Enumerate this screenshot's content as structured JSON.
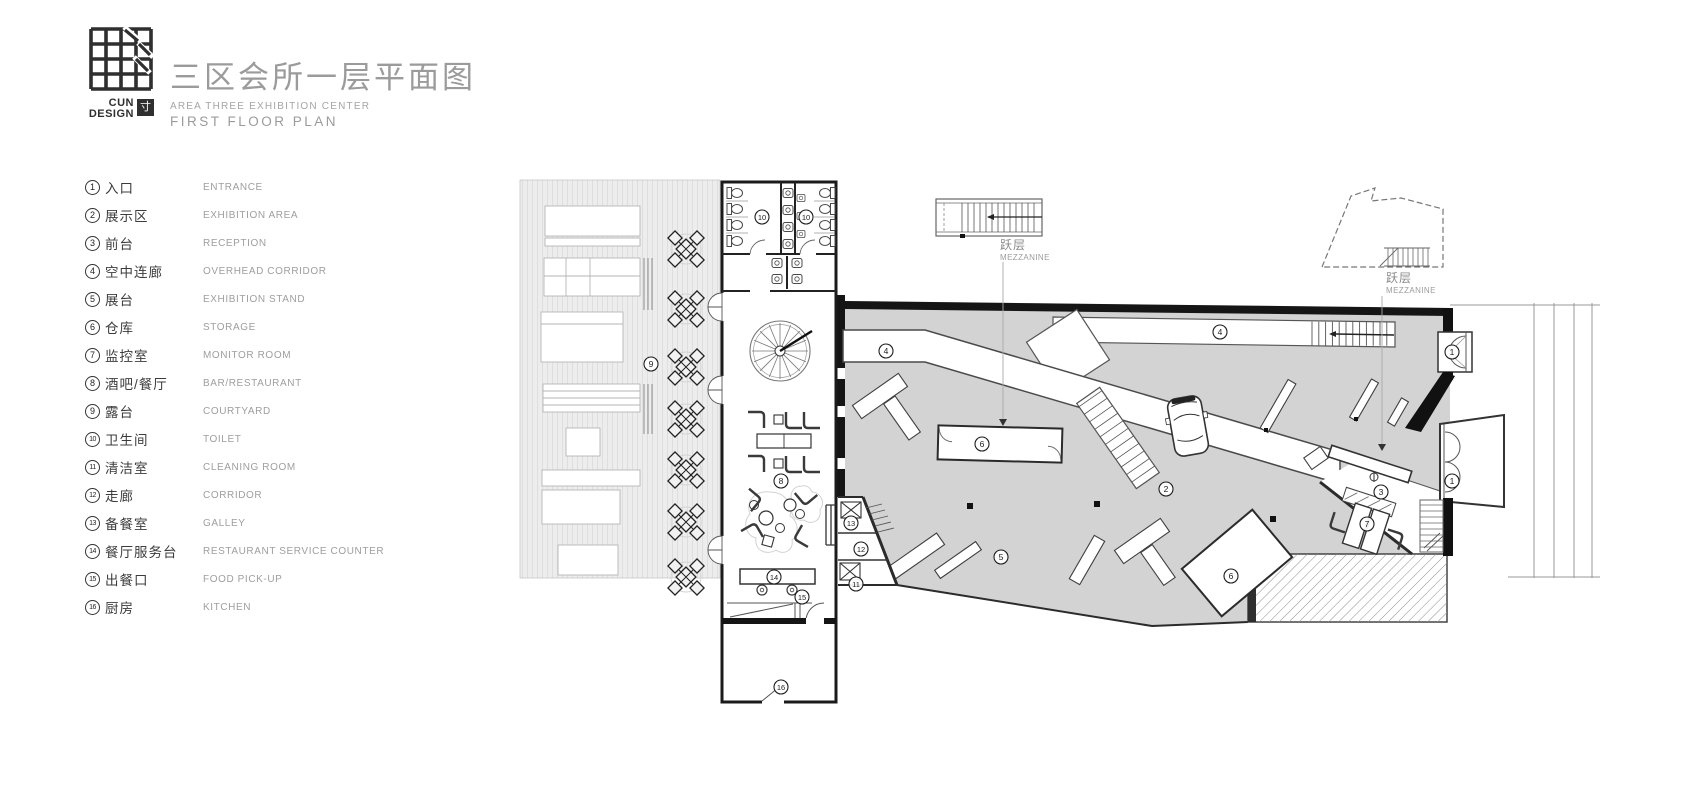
{
  "header": {
    "brand_top": "CUN",
    "brand_bottom": "DESIGN",
    "brand_seal": "寸",
    "title": "三区会所一层平面图",
    "subtitle_line1": "AREA THREE EXHIBITION CENTER",
    "subtitle_line2": "FIRST FLOOR PLAN"
  },
  "legend": {
    "items": [
      {
        "num": "1",
        "cn": "入口",
        "en": "ENTRANCE",
        "key": "entrance"
      },
      {
        "num": "2",
        "cn": "展示区",
        "en": "EXHIBITION AREA",
        "key": "exhibition-area"
      },
      {
        "num": "3",
        "cn": "前台",
        "en": "RECEPTION",
        "key": "reception"
      },
      {
        "num": "4",
        "cn": "空中连廊",
        "en": "OVERHEAD CORRIDOR",
        "key": "overhead-corridor"
      },
      {
        "num": "5",
        "cn": "展台",
        "en": "EXHIBITION STAND",
        "key": "exhibition-stand"
      },
      {
        "num": "6",
        "cn": "仓库",
        "en": "STORAGE",
        "key": "storage"
      },
      {
        "num": "7",
        "cn": "监控室",
        "en": "MONITOR ROOM",
        "key": "monitor-room"
      },
      {
        "num": "8",
        "cn": "酒吧/餐厅",
        "en": "BAR/RESTAURANT",
        "key": "bar-restaurant"
      },
      {
        "num": "9",
        "cn": "露台",
        "en": "COURTYARD",
        "key": "courtyard"
      },
      {
        "num": "10",
        "cn": "卫生间",
        "en": "TOILET",
        "key": "toilet"
      },
      {
        "num": "11",
        "cn": "清洁室",
        "en": "CLEANING ROOM",
        "key": "cleaning-room"
      },
      {
        "num": "12",
        "cn": "走廊",
        "en": "CORRIDOR",
        "key": "corridor"
      },
      {
        "num": "13",
        "cn": "备餐室",
        "en": "GALLEY",
        "key": "galley"
      },
      {
        "num": "14",
        "cn": "餐厅服务台",
        "en": "RESTAURANT SERVICE COUNTER",
        "key": "restaurant-service-counter"
      },
      {
        "num": "15",
        "cn": "出餐口",
        "en": "FOOD PICK-UP",
        "key": "food-pick-up"
      },
      {
        "num": "16",
        "cn": "厨房",
        "en": "KITCHEN",
        "key": "kitchen"
      }
    ]
  },
  "plan": {
    "room_labels": [
      {
        "num": "9",
        "key": "courtyard",
        "x": 651,
        "y": 364
      },
      {
        "num": "10",
        "key": "toilet",
        "x": 762,
        "y": 217
      },
      {
        "num": "10",
        "key": "toilet",
        "x": 806,
        "y": 217
      },
      {
        "num": "4",
        "key": "overhead-corridor",
        "x": 886,
        "y": 351
      },
      {
        "num": "4",
        "key": "overhead-corridor",
        "x": 1220,
        "y": 332
      },
      {
        "num": "8",
        "key": "bar-restaurant",
        "x": 781,
        "y": 481
      },
      {
        "num": "13",
        "key": "galley",
        "x": 851,
        "y": 523
      },
      {
        "num": "12",
        "key": "corridor",
        "x": 861,
        "y": 549
      },
      {
        "num": "11",
        "key": "cleaning-room",
        "x": 856,
        "y": 584
      },
      {
        "num": "14",
        "key": "restaurant-service-counter",
        "x": 774,
        "y": 577
      },
      {
        "num": "15",
        "key": "food-pick-up",
        "x": 802,
        "y": 597
      },
      {
        "num": "16",
        "key": "kitchen",
        "x": 781,
        "y": 687
      },
      {
        "num": "6",
        "key": "storage",
        "x": 982,
        "y": 444
      },
      {
        "num": "6",
        "key": "storage",
        "x": 1231,
        "y": 576
      },
      {
        "num": "5",
        "key": "exhibition-stand",
        "x": 1001,
        "y": 557
      },
      {
        "num": "2",
        "key": "exhibition-area",
        "x": 1166,
        "y": 489
      },
      {
        "num": "3",
        "key": "reception",
        "x": 1381,
        "y": 492
      },
      {
        "num": "7",
        "key": "monitor-room",
        "x": 1367,
        "y": 524
      },
      {
        "num": "1",
        "key": "entrance",
        "x": 1452,
        "y": 352
      },
      {
        "num": "1",
        "key": "entrance",
        "x": 1452,
        "y": 481
      }
    ],
    "mezzanine_labels": [
      {
        "cn": "跃层",
        "en": "MEZZANINE",
        "x": 1000,
        "y": 249
      },
      {
        "cn": "跃层",
        "en": "MEZZANINE",
        "x": 1386,
        "y": 282
      }
    ],
    "colors": {
      "hall_floor": "#d3d3d3",
      "terrace_floor": "#ededed",
      "wall": "#161616",
      "line": "#555555",
      "label_ink": "#1c1c1c",
      "title_gray": "#9b9b9b"
    }
  }
}
